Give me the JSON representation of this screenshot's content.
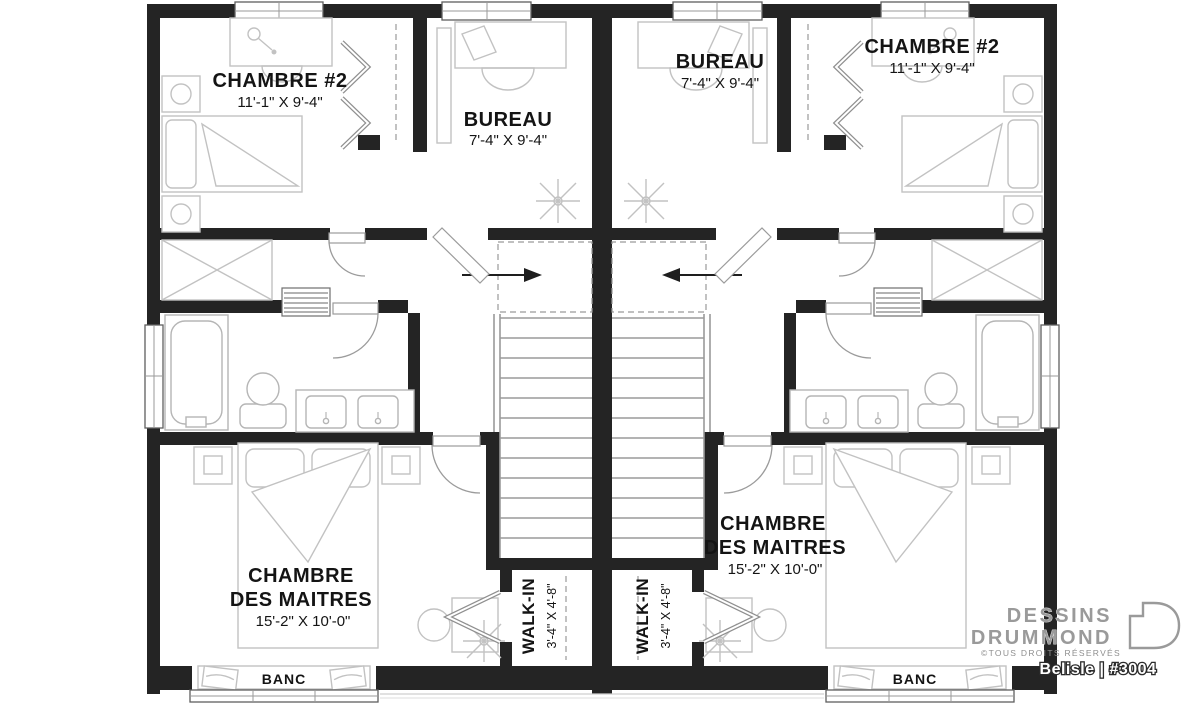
{
  "rooms": {
    "chambre2_left": {
      "name": "CHAMBRE #2",
      "dim": "11'-1\" X 9'-4\""
    },
    "bureau_left": {
      "name": "BUREAU",
      "dim": "7'-4\" X 9'-4\""
    },
    "bureau_right": {
      "name": "BUREAU",
      "dim": "7'-4\" X 9'-4\""
    },
    "chambre2_right": {
      "name": "CHAMBRE #2",
      "dim": "11'-1\" X 9'-4\""
    },
    "master_left": {
      "line1": "CHAMBRE",
      "line2": "DES MAITRES",
      "dim": "15'-2\" X 10'-0\""
    },
    "master_right": {
      "line1": "CHAMBRE",
      "line2": "DES MAITRES",
      "dim": "15'-2\" X 10'-0\""
    },
    "walkin_left": {
      "name": "WALK-IN",
      "dim": "3'-4\" X 4'-8\""
    },
    "walkin_right": {
      "name": "WALK-IN",
      "dim": "3'-4\" X 4'-8\""
    },
    "banc_left": {
      "name": "BANC"
    },
    "banc_right": {
      "name": "BANC"
    }
  },
  "branding": {
    "name_line1": "DESSINS",
    "name_line2": "DRUMMOND",
    "rights": "©TOUS DROITS RÉSERVÉS",
    "model": "Belisle | #3004"
  },
  "colors": {
    "wall": "#242424",
    "furniture_stroke": "#c2c2c2",
    "label_text": "#141414",
    "logo_gray": "#9a9a9a"
  }
}
